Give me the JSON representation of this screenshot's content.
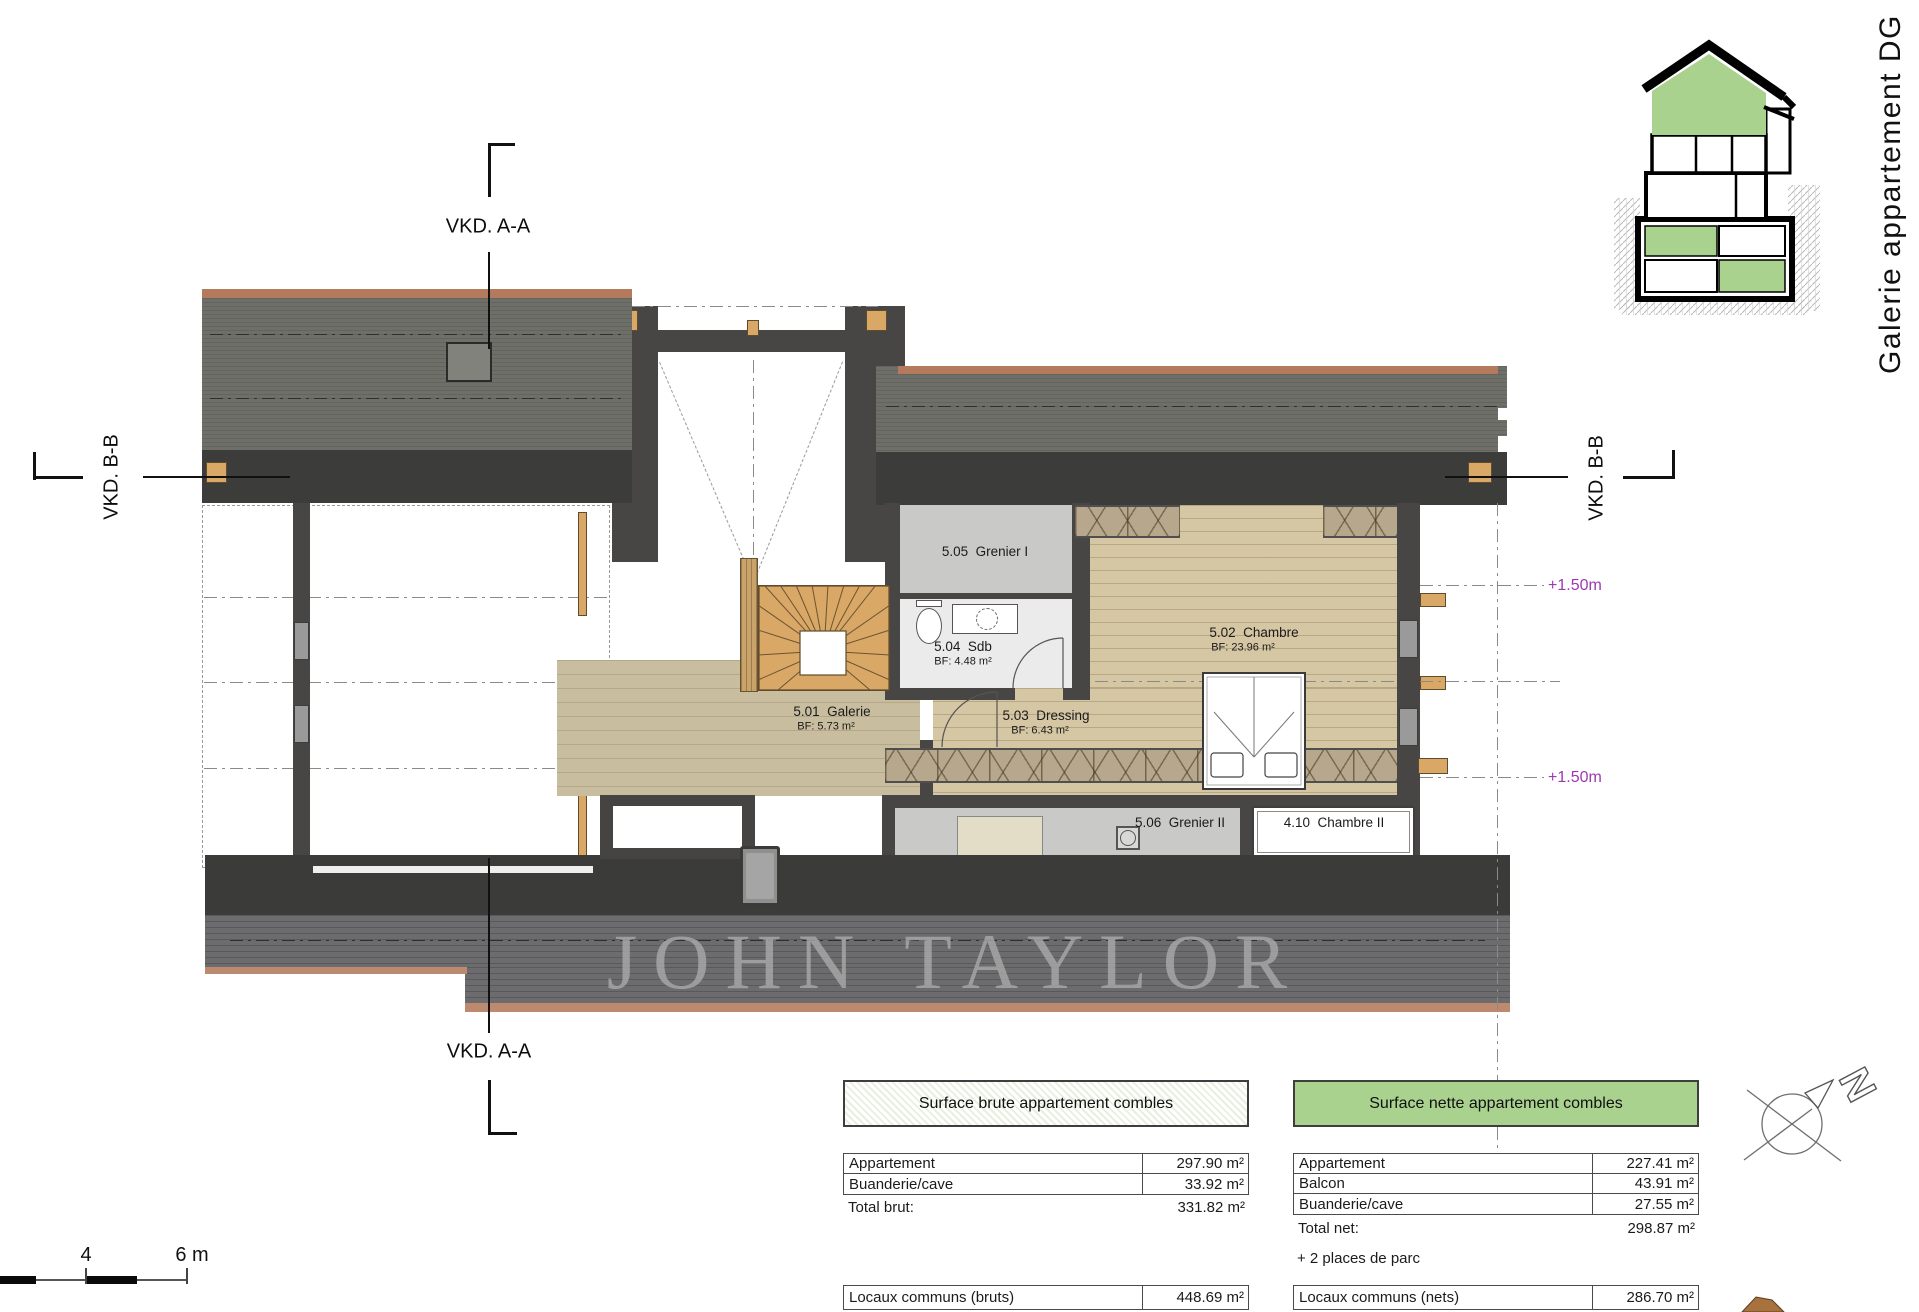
{
  "meta": {
    "plan_title_vertical": "Galerie appartement DG",
    "watermark": "JOHN TAYLOR"
  },
  "section_markers": {
    "top_a": "VKD. A-A",
    "bottom_a": "VKD. A-A",
    "left_b": "VKD. B-B",
    "right_b": "VKD. B-B"
  },
  "levels": {
    "upper": "+1.50m",
    "lower": "+1.50m"
  },
  "rooms": {
    "grenier1": {
      "label": "5.05  Grenier I"
    },
    "sdb": {
      "label": "5.04  Sdb",
      "area": "BF: 4.48 m²"
    },
    "galerie": {
      "label": "5.01  Galerie",
      "area": "BF: 5.73 m²"
    },
    "dressing": {
      "label": "5.03  Dressing",
      "area": "BF: 6.43 m²"
    },
    "chambre": {
      "label": "5.02  Chambre",
      "area": "BF: 23.96 m²"
    },
    "grenier2": {
      "label": "5.06  Grenier II"
    },
    "chambre2": {
      "label": "4.10  Chambre II"
    }
  },
  "scale_bar": {
    "tick_mid": "4",
    "tick_end": "6 m"
  },
  "compass": {
    "north": "N"
  },
  "tables": {
    "brute": {
      "header": "Surface brute appartement combles",
      "rows": [
        {
          "label": "Appartement",
          "value": "297.90 m²"
        },
        {
          "label": "Buanderie/cave",
          "value": "33.92 m²"
        }
      ],
      "total_label": "Total brut:",
      "total_value": "331.82 m²",
      "commons_label": "Locaux communs (bruts)",
      "commons_value": "448.69 m²"
    },
    "nette": {
      "header": "Surface nette appartement combles",
      "rows": [
        {
          "label": "Appartement",
          "value": "227.41 m²"
        },
        {
          "label": "Balcon",
          "value": "43.91 m²"
        },
        {
          "label": "Buanderie/cave",
          "value": "27.55 m²"
        }
      ],
      "total_label": "Total net:",
      "total_value": "298.87 m²",
      "note": "+ 2 places de parc",
      "commons_label": "Locaux communs (nets)",
      "commons_value": "286.70 m²"
    }
  },
  "colors": {
    "accent_green": "#a9d28e",
    "level_purple": "#9b3ab0",
    "roof_gray": "#6f6f69",
    "eave_dark": "#3c3c3b",
    "wall_dark": "#474645",
    "wood_floor": "#d5c6a4",
    "galerie_floor": "#c9bda0",
    "stair_wood": "#d9a766",
    "grenier_gray": "#c9c9c7",
    "roof_edge_salmon": "#bd8a70",
    "watermark_gray": "#a8a8a8"
  }
}
